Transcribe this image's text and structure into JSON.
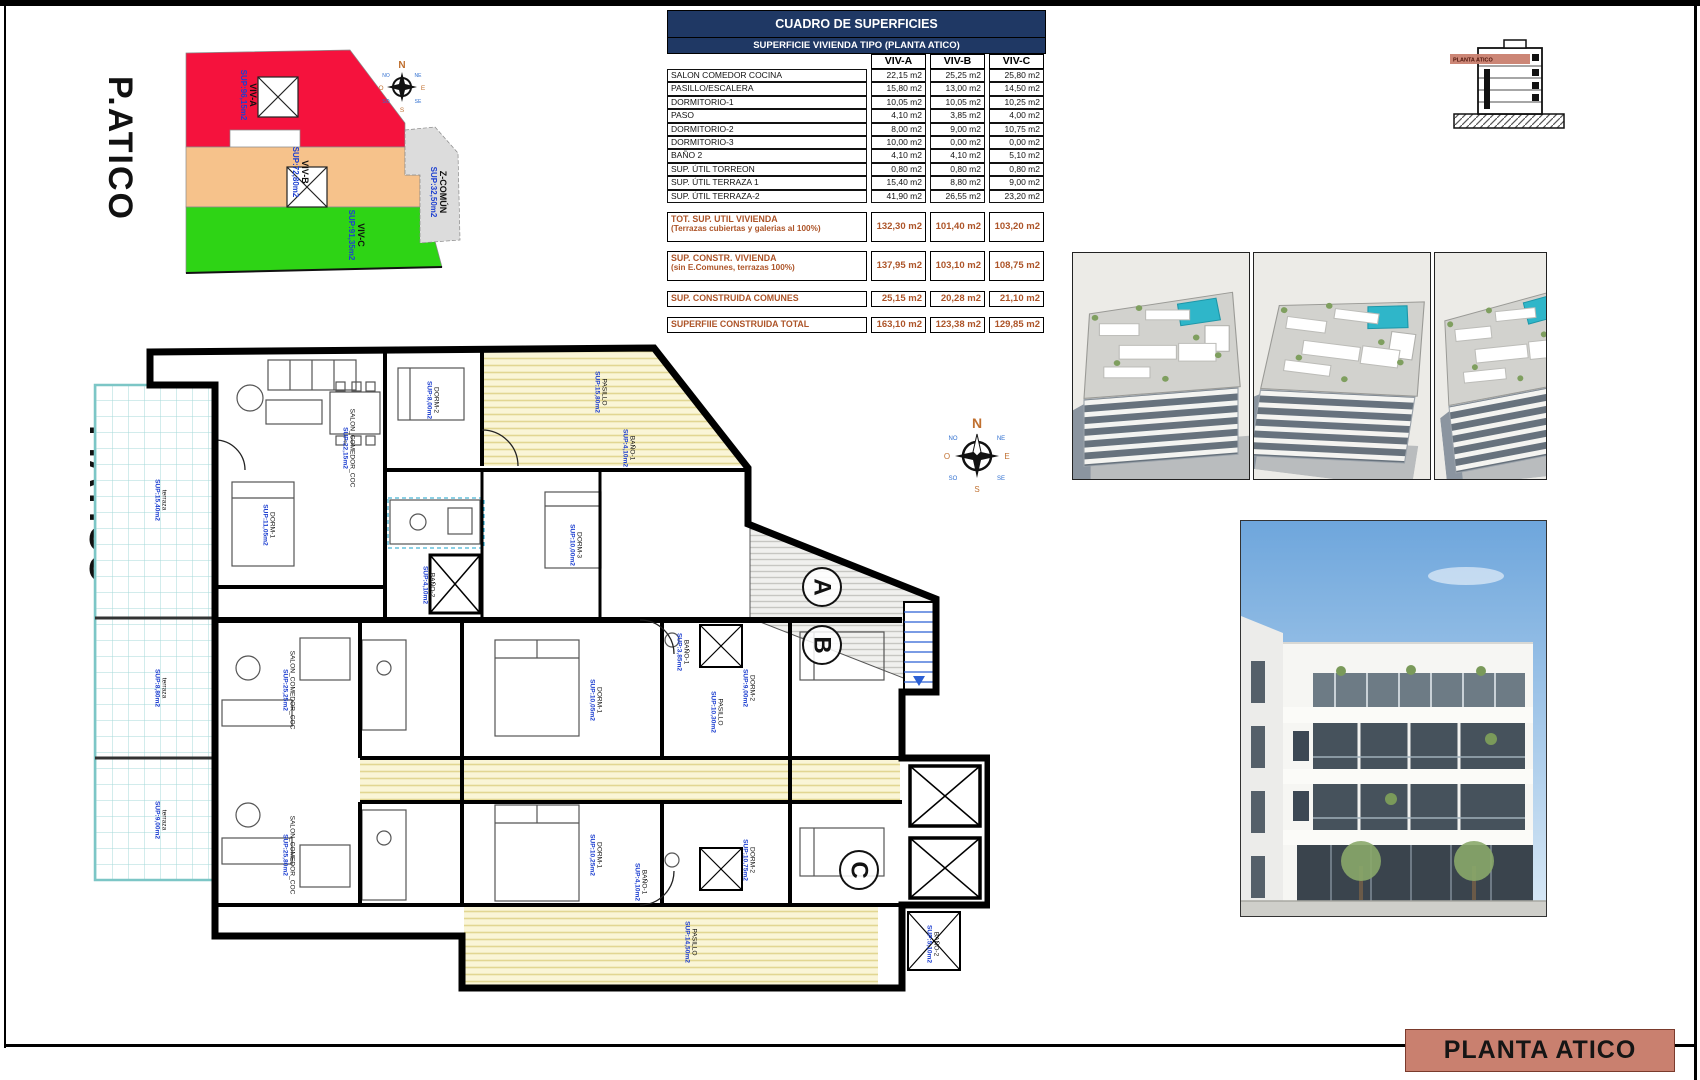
{
  "site_plan": {
    "title": "P.ATICO",
    "zones": [
      {
        "name": "VIV-A",
        "sup": "SUP:96,15m2",
        "color": "#f5123d",
        "x": 248,
        "y": 95
      },
      {
        "name": "VIV-B",
        "sup": "SUP:72,80m2",
        "color": "#f6c28b",
        "x": 300,
        "y": 172
      },
      {
        "name": "VIV-C",
        "sup": "SUP:91,35m2",
        "color": "#2ed415",
        "x": 356,
        "y": 235
      },
      {
        "name": "Z-COMÚN",
        "sup": "SUP:32,50m2",
        "color": "#dcdcdc",
        "x": 438,
        "y": 192
      }
    ]
  },
  "table": {
    "title": "CUADRO DE SUPERFICIES",
    "subtitle": "SUPERFICIE VIVIENDA TIPO  (PLANTA ATICO)",
    "columns": [
      "VIV-A",
      "VIV-B",
      "VIV-C"
    ],
    "rows": [
      [
        "SALON COMEDOR COCINA",
        "22,15 m2",
        "25,25 m2",
        "25,80 m2"
      ],
      [
        "PASILLO/ESCALERA",
        "15,80 m2",
        "13,00 m2",
        "14,50 m2"
      ],
      [
        "DORMITORIO-1",
        "10,05 m2",
        "10,05 m2",
        "10,25 m2"
      ],
      [
        "PASO",
        "4,10 m2",
        "3,85 m2",
        "4,00 m2"
      ],
      [
        "DORMITORIO-2",
        "8,00 m2",
        "9,00 m2",
        "10,75 m2"
      ],
      [
        "DORMITORIO-3",
        "10,00 m2",
        "0,00 m2",
        "0,00 m2"
      ],
      [
        "BAÑO 2",
        "4,10 m2",
        "4,10 m2",
        "5,10 m2"
      ],
      [
        "SUP. ÚTIL TORREON",
        "0,80 m2",
        "0,80 m2",
        "0,80 m2"
      ],
      [
        "SUP. ÚTIL TERRAZA 1",
        "15,40 m2",
        "8,80 m2",
        "9,00 m2"
      ],
      [
        "SUP. ÚTIL TERRAZA-2",
        "41,90 m2",
        "26,55 m2",
        "23,20 m2"
      ]
    ],
    "summary_rows": [
      {
        "label": "TOT. SUP. UTIL VIVIENDA",
        "sublabel": "(Terrazas cubiertas y galerias al 100%)",
        "values": [
          "132,30 m2",
          "101,40 m2",
          "103,20 m2"
        ]
      },
      {
        "label": "SUP. CONSTR. VIVIENDA",
        "sublabel": "(sin E.Comunes, terrazas 100%)",
        "values": [
          "137,95 m2",
          "103,10 m2",
          "108,75 m2"
        ]
      },
      {
        "label": "SUP. CONSTRUIDA COMUNES",
        "sublabel": "",
        "values": [
          "25,15 m2",
          "20,28 m2",
          "21,10 m2"
        ]
      },
      {
        "label": "SUPERFIIE CONSTRUIDA TOTAL",
        "sublabel": "",
        "values": [
          "163,10 m2",
          "123,38 m2",
          "129,85 m2"
        ]
      }
    ]
  },
  "section_diagram": {
    "label": "PLANTA ATICO"
  },
  "compass": {
    "n": "N",
    "s": "S",
    "e": "E",
    "o": "O",
    "ne": "NE",
    "no": "NO",
    "se": "SE",
    "so": "SO"
  },
  "floor_plan": {
    "title": "P.ATICO",
    "markers": [
      {
        "letter": "A",
        "x": 820,
        "y": 585
      },
      {
        "letter": "B",
        "x": 820,
        "y": 643
      },
      {
        "letter": "C",
        "x": 857,
        "y": 868
      }
    ],
    "labels": [
      {
        "name": "terraza",
        "sup": "SUP:15,40m2",
        "x": 160,
        "y": 500,
        "rot": 90
      },
      {
        "name": "terraza",
        "sup": "SUP:8,80m2",
        "x": 160,
        "y": 688,
        "rot": 90
      },
      {
        "name": "terraza",
        "sup": "SUP:9,00m2",
        "x": 160,
        "y": 820,
        "rot": 90
      },
      {
        "name": "SALON_COMEDOR_COC",
        "sup": "SUP:22,15m2",
        "x": 348,
        "y": 448,
        "rot": 90
      },
      {
        "name": "PASILLO",
        "sup": "SUP:15,80m2",
        "x": 600,
        "y": 392,
        "rot": 90
      },
      {
        "name": "DORM-2",
        "sup": "SUP:8,00m2",
        "x": 432,
        "y": 400,
        "rot": 90
      },
      {
        "name": "BAÑO-1",
        "sup": "SUP:4,10m2",
        "x": 628,
        "y": 448,
        "rot": 90
      },
      {
        "name": "DORM-3",
        "sup": "SUP:10,00m2",
        "x": 575,
        "y": 545,
        "rot": 90
      },
      {
        "name": "DORM-1",
        "sup": "SUP:11,05m2",
        "x": 268,
        "y": 525,
        "rot": 90
      },
      {
        "name": "BAÑO-2",
        "sup": "SUP:4,10m2",
        "x": 428,
        "y": 585,
        "rot": 90
      },
      {
        "name": "SALON_COMEDOR_COC",
        "sup": "SUP:25,25m2",
        "x": 288,
        "y": 690,
        "rot": 90
      },
      {
        "name": "DORM-1",
        "sup": "SUP:10,05m2",
        "x": 595,
        "y": 700,
        "rot": 90
      },
      {
        "name": "BAÑO-1",
        "sup": "SUP:3,85m2",
        "x": 682,
        "y": 652,
        "rot": 90
      },
      {
        "name": "PASILLO",
        "sup": "SUP:10,30m2",
        "x": 716,
        "y": 712,
        "rot": 90
      },
      {
        "name": "DORM-2",
        "sup": "SUP:9,00m2",
        "x": 748,
        "y": 688,
        "rot": 90
      },
      {
        "name": "SALON_COMEDOR_COC",
        "sup": "SUP:25,80m2",
        "x": 288,
        "y": 855,
        "rot": 90
      },
      {
        "name": "DORM-1",
        "sup": "SUP:10,25m2",
        "x": 595,
        "y": 855,
        "rot": 90
      },
      {
        "name": "BAÑO-1",
        "sup": "SUP:4,10m2",
        "x": 640,
        "y": 882,
        "rot": 90
      },
      {
        "name": "DORM-2",
        "sup": "SUP:10,75m2",
        "x": 748,
        "y": 860,
        "rot": 90
      },
      {
        "name": "PASILLO",
        "sup": "SUP:14,50m2",
        "x": 690,
        "y": 942,
        "rot": 90
      },
      {
        "name": "BAÑO-2",
        "sup": "SUP:5,10m2",
        "x": 932,
        "y": 944,
        "rot": 90
      }
    ]
  },
  "title_bar": {
    "text": "PLANTA ATICO"
  }
}
